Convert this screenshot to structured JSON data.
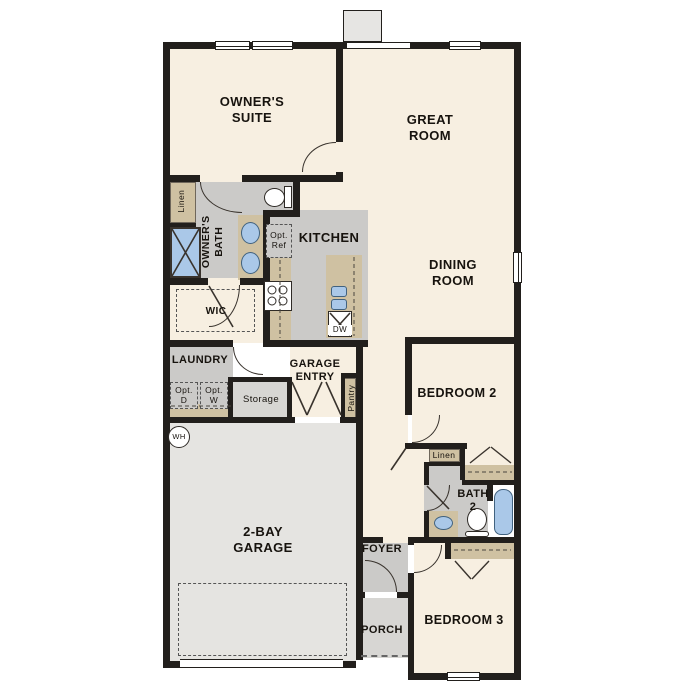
{
  "meta": {
    "kind": "single-story floor plan",
    "canvas_w": 687,
    "canvas_h": 687
  },
  "colors": {
    "wall": "#221f1c",
    "floor_living": "#f7efe1",
    "floor_tile": "#cbcac8",
    "floor_garage": "#e5e4e1",
    "floor_porch": "#d7d6d3",
    "counter": "#cfc1a2",
    "fixture_blue": "#aac8e8",
    "fireplace": "#e6e5e3"
  },
  "labels": {
    "owners_suite": "OWNER'S\nSUITE",
    "great_room": "GREAT\nROOM",
    "dining_room": "DINING\nROOM",
    "kitchen": "KITCHEN",
    "owners_bath": "OWNER'S\nBATH",
    "linen_owners": "Linen",
    "wic": "WIC",
    "opt_ref": "Opt.\nRef",
    "dw": "DW",
    "laundry": "LAUNDRY",
    "opt_d": "Opt.\nD",
    "opt_w": "Opt.\nW",
    "storage": "Storage",
    "garage_entry": "GARAGE\nENTRY",
    "pantry": "Pantry",
    "water_heater": "WH",
    "garage": "2-BAY\nGARAGE",
    "bedroom2": "BEDROOM 2",
    "linen_hall": "Linen",
    "bath2": "BATH\n2",
    "foyer": "FOYER",
    "porch": "PORCH",
    "bedroom3": "BEDROOM 3"
  }
}
